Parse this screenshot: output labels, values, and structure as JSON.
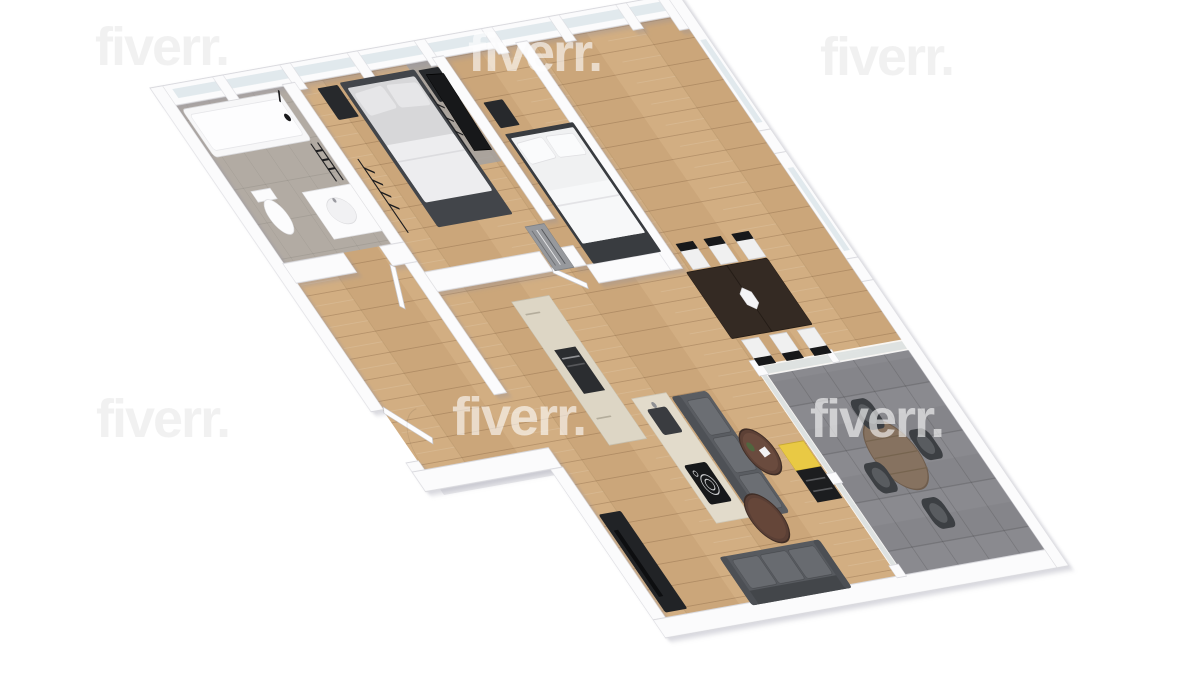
{
  "meta": {
    "title": "3D rendered floor plan of a two-bedroom apartment",
    "view": "axonometric top-down 3D render",
    "background_color": "#ffffff"
  },
  "watermark": {
    "text": "fiverr.",
    "instances": [
      {
        "id": "top-left",
        "tone": "dark"
      },
      {
        "id": "top-center",
        "tone": "light"
      },
      {
        "id": "top-right",
        "tone": "dark"
      },
      {
        "id": "mid-left",
        "tone": "dark"
      },
      {
        "id": "mid-center",
        "tone": "light"
      },
      {
        "id": "mid-right",
        "tone": "light"
      }
    ]
  },
  "palette": {
    "wall": "#fbfbfc",
    "wall_edge": "#d9d9de",
    "wood_floor": "#cba67a",
    "bathroom_tile": "#b2aba3",
    "terrace_tile": "#85858a",
    "glass": "#e1e9ed",
    "sofa_gray": "#5a5d62",
    "cushion_gray": "#6b6e73",
    "bed_base_dark": "#42454a",
    "mattress_light": "#d7d7d9",
    "bedding_white": "#f0f1f2",
    "black_furniture": "#27292c",
    "dining_table_wood": "#342a23",
    "chair_seat_white": "#f0f0f0",
    "coffee_table_brown": "#5d4136",
    "terrace_table_wood": "#867260",
    "kitchen_cream": "#ddd6c5",
    "oven_dark": "#2b2d30",
    "accent_yellow": "#e9c944",
    "mirror_dark": "#17181a",
    "rug_gray": "#a0a0a3"
  },
  "apartment": {
    "rooms": [
      {
        "id": "master-bedroom",
        "floor": "wood",
        "furniture": [
          "double bed with gray mattress and dark base",
          "two black nightstands",
          "clothes rack with hangers",
          "gray rug",
          "leaning dark mirror",
          "second hanger rack"
        ]
      },
      {
        "id": "bathroom",
        "floor": "gray tile",
        "furniture": [
          "bathtub with black fixtures",
          "toilet",
          "white vanity with basin",
          "black towel ladder"
        ]
      },
      {
        "id": "entrance-hall",
        "floor": "wood",
        "furniture": [
          "entry door (open)"
        ]
      },
      {
        "id": "second-bedroom",
        "floor": "wood",
        "furniture": [
          "double bed with white bedding and dark base",
          "black nightstand",
          "gray dresser in closet nook"
        ]
      },
      {
        "id": "kitchen",
        "floor": "wood",
        "furniture": [
          "cream tall cabinet wall with built-in oven",
          "cream island with sink and black cooktop"
        ]
      },
      {
        "id": "living-room",
        "floor": "wood",
        "furniture": [
          "gray sofa at island",
          "gray sofa at south wall",
          "two round brown coffee tables",
          "black TV console",
          "yellow accent cabinet"
        ]
      },
      {
        "id": "dining-area",
        "floor": "wood",
        "furniture": [
          "dark wood dining table",
          "six black chairs with white seats",
          "white hexagonal centerpiece"
        ]
      },
      {
        "id": "terrace",
        "floor": "gray tile",
        "furniture": [
          "round wooden table",
          "four dark armchairs",
          "glass partition walls"
        ]
      }
    ]
  }
}
